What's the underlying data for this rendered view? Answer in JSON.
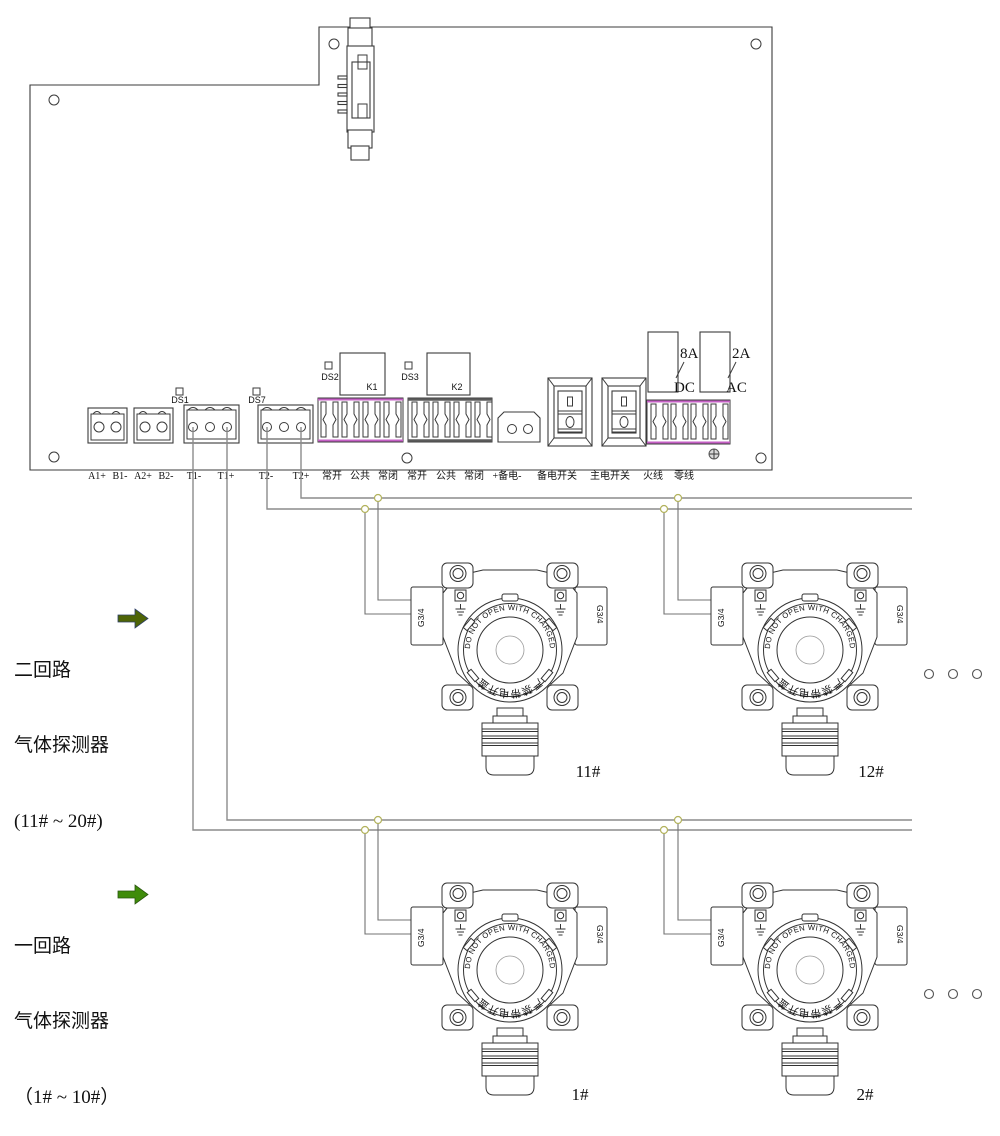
{
  "board": {
    "silkscreen": {
      "ds1": "DS1",
      "ds7": "DS7",
      "ds2": "DS2",
      "ds3": "DS3",
      "k1": "K1",
      "k2": "K2"
    },
    "fuses": {
      "dc_rating": "8A",
      "dc_label": "DC",
      "ac_rating": "2A",
      "ac_label": "AC"
    },
    "terminals": [
      "A1+",
      "B1-",
      "A2+",
      "B2-",
      "T1-",
      "T1+",
      "T2-",
      "T2+",
      "常开",
      "公共",
      "常闭",
      "常开",
      "公共",
      "常闭",
      "+备电-",
      "备电开关",
      "主电开关",
      "火线",
      "零线"
    ]
  },
  "loops": {
    "loop2": {
      "line1": "二回路",
      "line2": "气体探测器",
      "line3": "(11# ~ 20#)",
      "arrow_color": "#4e6406",
      "detectors": [
        "11#",
        "12#"
      ]
    },
    "loop1": {
      "line1": "一回路",
      "line2": "气体探测器",
      "line3": "（1# ~ 10#）",
      "arrow_color": "#3f8c0a",
      "detectors": [
        "1#",
        "2#"
      ]
    }
  },
  "detector": {
    "gland_label": "G3/4",
    "warning_en": "DO NOT OPEN WITH CHARGED",
    "warning_cn": "严禁带电开盖"
  },
  "colors": {
    "accent_magenta": "#c55fc5",
    "wire_gray": "#8c8c8c",
    "node_stroke": "#b2b25c",
    "outline": "#3b3b3b"
  }
}
